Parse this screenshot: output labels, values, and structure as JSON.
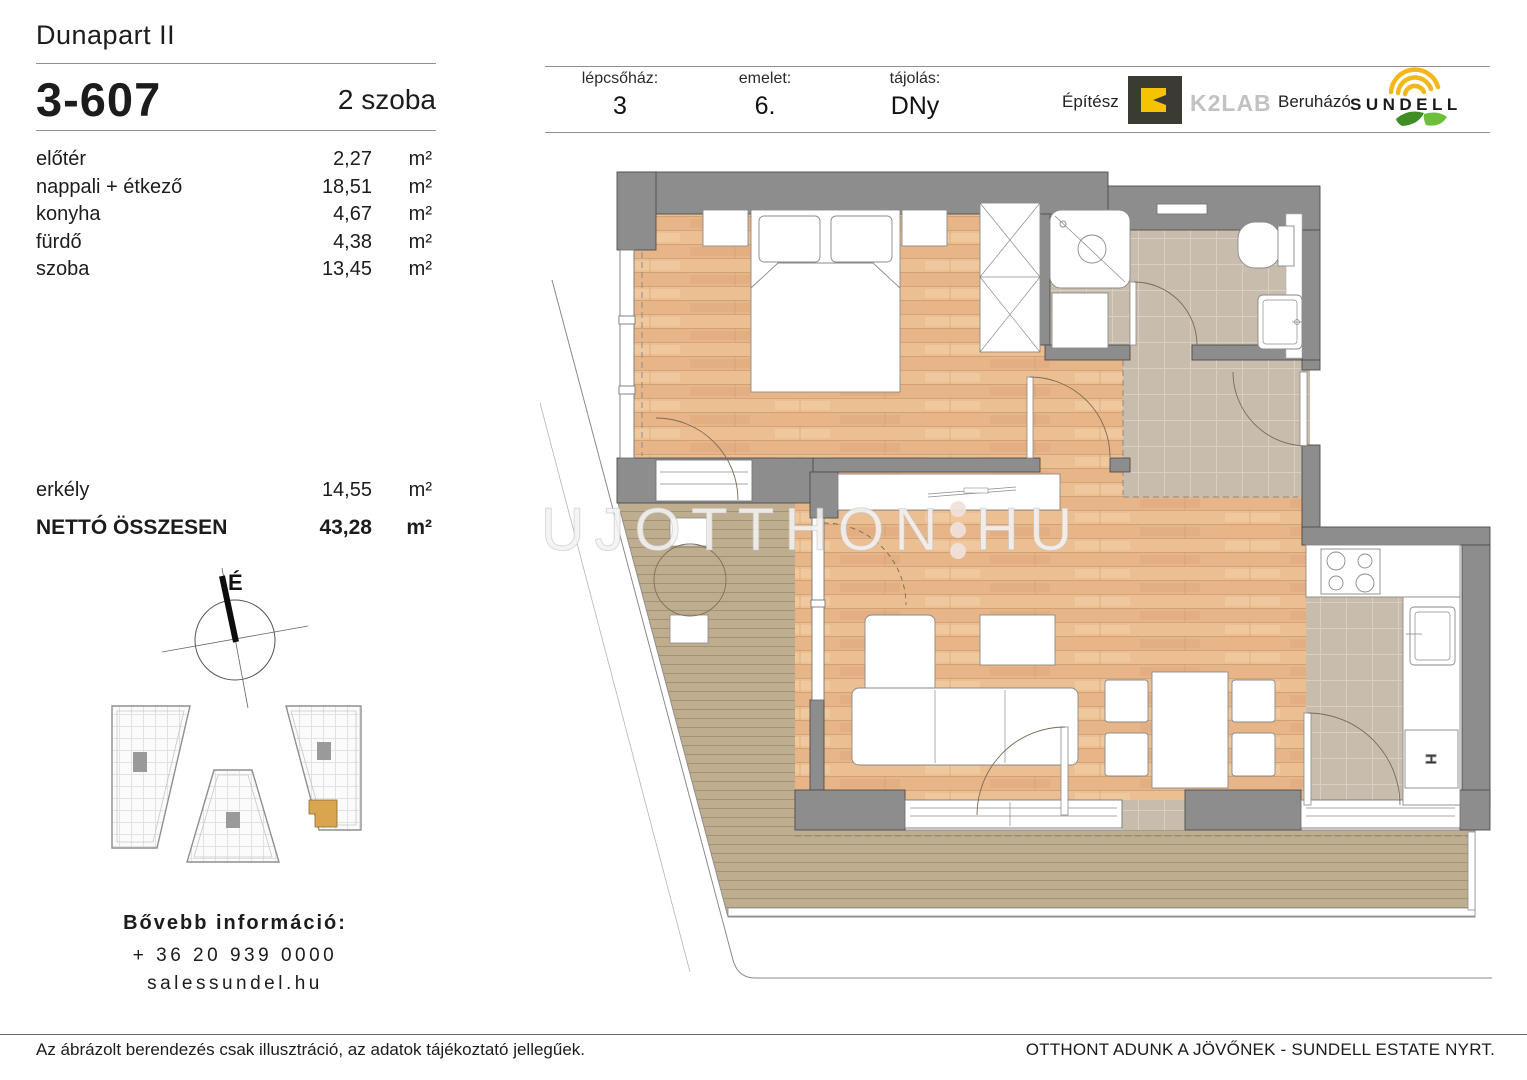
{
  "header": {
    "project": "Dunapart II",
    "unit_id": "3-607",
    "unit_type": "2 szoba",
    "fields": [
      {
        "label": "lépcsőház:",
        "value": "3"
      },
      {
        "label": "emelet:",
        "value": "6."
      },
      {
        "label": "tájolás:",
        "value": "DNy"
      }
    ],
    "architect_label": "Építész",
    "architect_name": "K2LAB",
    "developer_label": "Beruházó",
    "developer_name": "SUNDELL"
  },
  "areas": {
    "unit": "m²",
    "rooms": [
      {
        "name": "előtér",
        "value": "2,27"
      },
      {
        "name": "nappali + étkező",
        "value": "18,51"
      },
      {
        "name": "konyha",
        "value": "4,67"
      },
      {
        "name": "fürdő",
        "value": "4,38"
      },
      {
        "name": "szoba",
        "value": "13,45"
      }
    ],
    "balcony": {
      "name": "erkély",
      "value": "14,55"
    },
    "total": {
      "name": "NETTÓ ÖSSZESEN",
      "value": "43,28"
    }
  },
  "compass": {
    "north_label": "É"
  },
  "contact": {
    "heading": "Bővebb információ:",
    "phone": "+ 36 20 939 0000",
    "website": "salessundel.hu"
  },
  "footer": {
    "disclaimer": "Az ábrázolt berendezés csak illusztráció, az adatok tájékoztató jellegűek.",
    "slogan": "OTTHONT ADUNK A JÖVŐNEK - SUNDELL ESTATE NYRT."
  },
  "watermark": {
    "part1": "UJOTTHON",
    "part2": "HU"
  },
  "plan": {
    "fridge_symbol": "H"
  },
  "colors": {
    "wall": "#8d8d8d",
    "wood": "#eaba8d",
    "tile": "#c8bcad",
    "deck": "#bfad90",
    "highlight": "#d9a54f",
    "brand_yellow": "#f2b718",
    "brand_green": "#4e9b2e"
  }
}
